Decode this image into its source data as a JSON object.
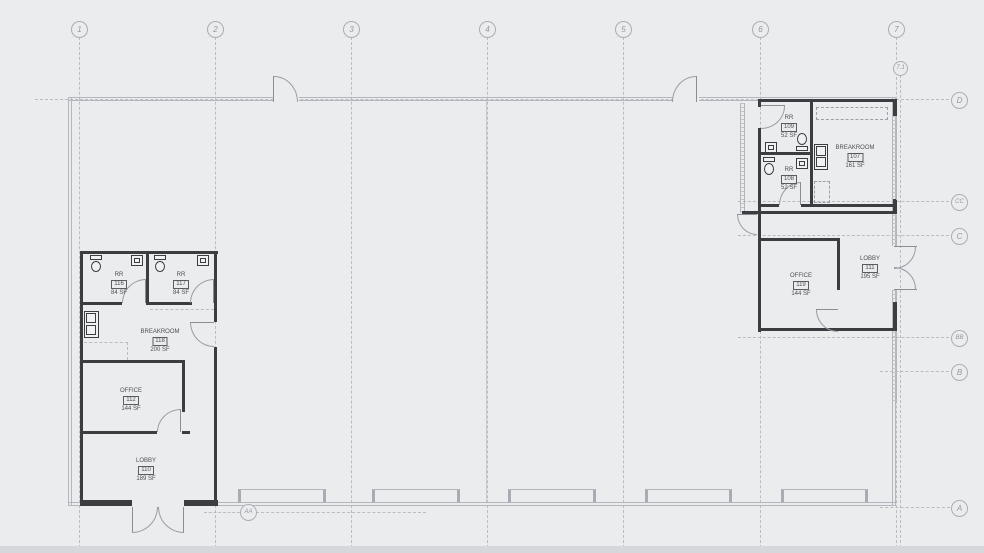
{
  "drawing": {
    "type": "architectural floor plan",
    "colors": {
      "background": "#ebecee",
      "dark_wall": "#3b3d40",
      "light_line": "#b3b7bd",
      "label_text": "#4d5054",
      "grid_text": "#94989e"
    }
  },
  "grid": {
    "columns": [
      {
        "label": "1"
      },
      {
        "label": "2"
      },
      {
        "label": "3"
      },
      {
        "label": "4"
      },
      {
        "label": "5"
      },
      {
        "label": "6"
      },
      {
        "label": "7"
      },
      {
        "label": "7.1"
      }
    ],
    "rows": [
      {
        "label": "D"
      },
      {
        "label": "CC"
      },
      {
        "label": "C"
      },
      {
        "label": "BB"
      },
      {
        "label": "B"
      },
      {
        "label": "A"
      },
      {
        "label": "AA"
      }
    ]
  },
  "rooms": {
    "left_suite": [
      {
        "name": "RR",
        "number": "116",
        "area": "84 SF"
      },
      {
        "name": "RR",
        "number": "117",
        "area": "84 SF"
      },
      {
        "name": "BREAKROOM",
        "number": "118",
        "area": "200 SF"
      },
      {
        "name": "OFFICE",
        "number": "112",
        "area": "144 SF"
      },
      {
        "name": "LOBBY",
        "number": "110",
        "area": "189 SF"
      }
    ],
    "right_suite": [
      {
        "name": "RR",
        "number": "109",
        "area": "52 SF"
      },
      {
        "name": "RR",
        "number": "108",
        "area": "52 SF"
      },
      {
        "name": "BREAKROOM",
        "number": "107",
        "area": "161 SF"
      },
      {
        "name": "OFFICE",
        "number": "119",
        "area": "144 SF"
      },
      {
        "name": "LOBBY",
        "number": "111",
        "area": "195 SF"
      }
    ]
  }
}
